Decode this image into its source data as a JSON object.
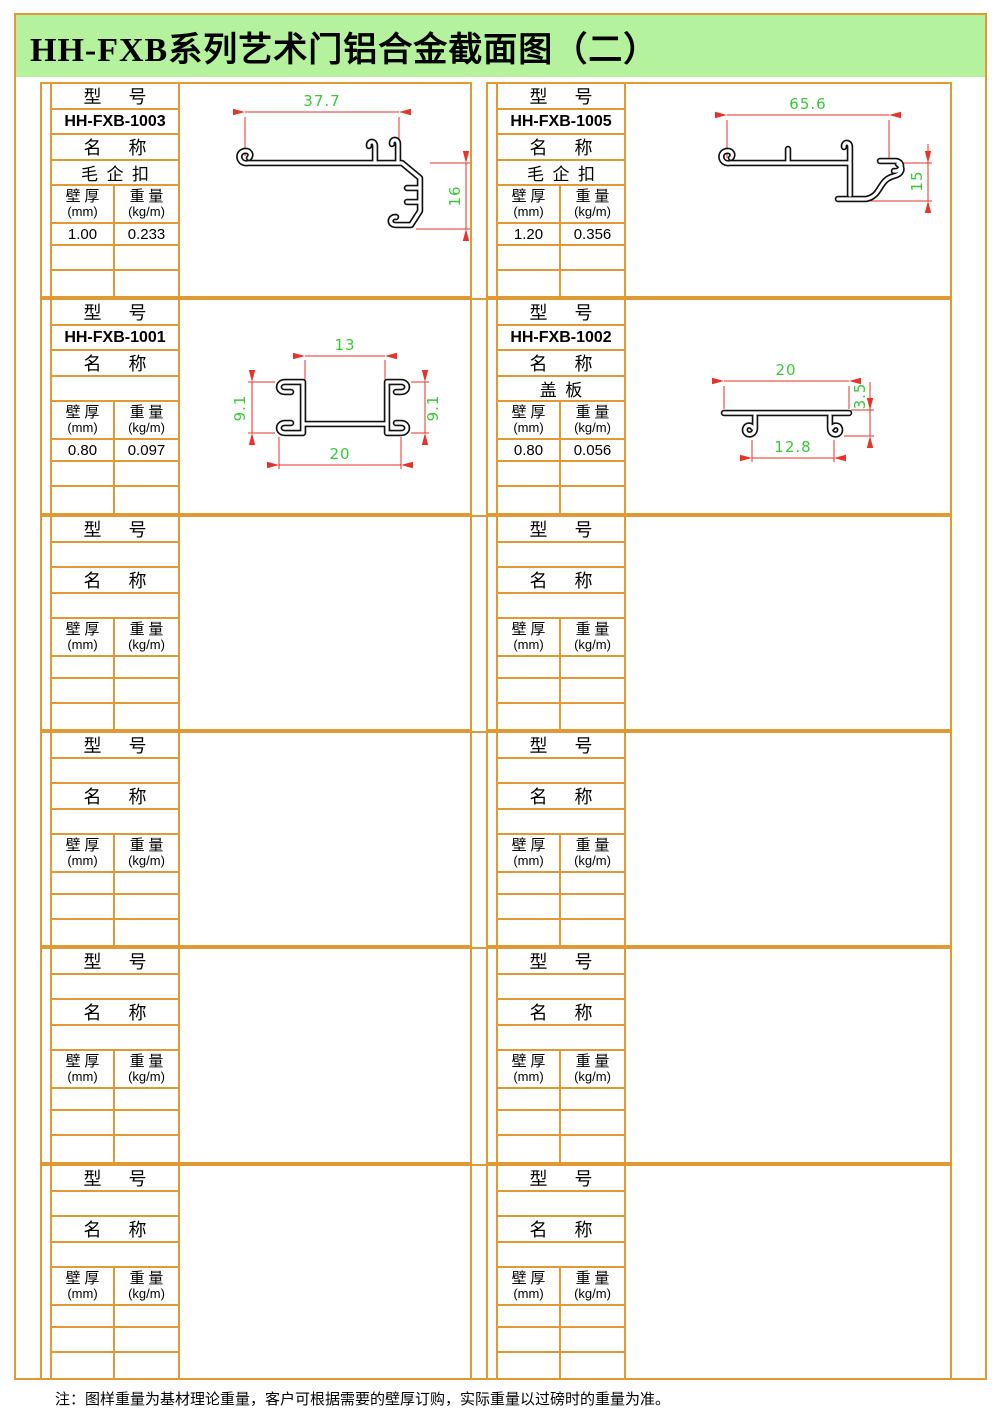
{
  "title": "HH-FXB系列艺术门铝合金截面图（二）",
  "footnote": "注：图样重量为基材理论重量，客户可根据需要的壁厚订购，实际重量以过磅时的重量为准。",
  "labels": {
    "model": "型      号",
    "name": "名      称",
    "thickness_cn": "壁 厚",
    "thickness_unit": "(mm)",
    "weight_cn": "重 量",
    "weight_unit": "(kg/m)"
  },
  "colors": {
    "border_orange": "#E19A33",
    "title_green_bg": "#B4F29E",
    "dimension_line_red": "#E8322A",
    "dimension_text_green": "#35CB35",
    "profile_black": "#111111"
  },
  "cells": [
    {
      "model": "HH-FXB-1003",
      "name": "毛  企  扣",
      "thickness": "1.00",
      "weight": "0.233",
      "dims": {
        "width": "37.7",
        "height": "16"
      }
    },
    {
      "model": "HH-FXB-1005",
      "name": "毛  企  扣",
      "thickness": "1.20",
      "weight": "0.356",
      "dims": {
        "width": "65.6",
        "height": "15"
      }
    },
    {
      "model": "HH-FXB-1001",
      "name": "",
      "thickness": "0.80",
      "weight": "0.097",
      "dims": {
        "top": "13",
        "bottom": "20",
        "left": "9.1",
        "right": "9.1"
      }
    },
    {
      "model": "HH-FXB-1002",
      "name": "盖  板",
      "thickness": "0.80",
      "weight": "0.056",
      "dims": {
        "top": "20",
        "bottom": "12.8",
        "right": "3.5"
      }
    },
    {
      "model": "",
      "name": "",
      "thickness": "",
      "weight": ""
    },
    {
      "model": "",
      "name": "",
      "thickness": "",
      "weight": ""
    },
    {
      "model": "",
      "name": "",
      "thickness": "",
      "weight": ""
    },
    {
      "model": "",
      "name": "",
      "thickness": "",
      "weight": ""
    },
    {
      "model": "",
      "name": "",
      "thickness": "",
      "weight": ""
    },
    {
      "model": "",
      "name": "",
      "thickness": "",
      "weight": ""
    },
    {
      "model": "",
      "name": "",
      "thickness": "",
      "weight": ""
    },
    {
      "model": "",
      "name": "",
      "thickness": "",
      "weight": ""
    }
  ]
}
